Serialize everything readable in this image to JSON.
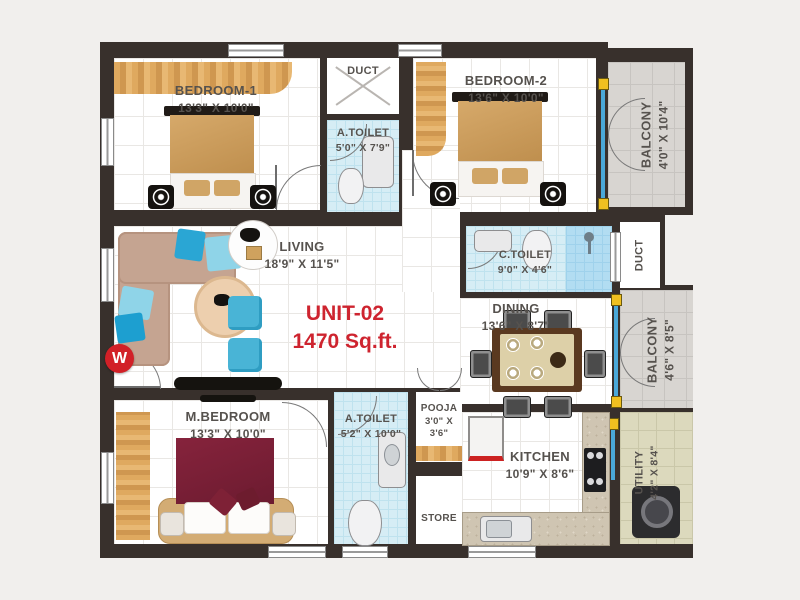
{
  "unit": {
    "title": "UNIT-02",
    "area": "1470 Sq.ft."
  },
  "compass": {
    "west_label": "W"
  },
  "rooms": {
    "bedroom1": {
      "name": "BEDROOM-1",
      "dims": "13'3\" X 10'0\""
    },
    "duct_top": {
      "name": "DUCT"
    },
    "atoilet1": {
      "name": "A.TOILET",
      "dims": "5'0\" X 7'9\""
    },
    "bedroom2": {
      "name": "BEDROOM-2",
      "dims": "13'6\" X 10'0\""
    },
    "balcony1": {
      "name": "BALCONY",
      "dims": "4'0\" X 10'4\""
    },
    "living": {
      "name": "LIVING",
      "dims": "18'9\" X 11'5\""
    },
    "ctoilet": {
      "name": "C.TOILET",
      "dims": "9'0\" X 4'6\""
    },
    "duct_right": {
      "name": "DUCT"
    },
    "dining": {
      "name": "DINING",
      "dims": "13'6\" X 8'7\""
    },
    "balcony2": {
      "name": "BALCONY",
      "dims": "4'6\" X 8'5\""
    },
    "mbedroom": {
      "name": "M.BEDROOM",
      "dims": "13'3\" X 10'0\""
    },
    "atoilet2": {
      "name": "A.TOILET",
      "dims": "5'2\" X 10'0\""
    },
    "pooja": {
      "name": "POOJA",
      "dims": "3'0\" X 3'6\""
    },
    "store": {
      "name": "STORE"
    },
    "kitchen": {
      "name": "KITCHEN",
      "dims": "10'9\" X 8'6\""
    },
    "utility": {
      "name": "UTILITY",
      "dims": "4'2\" X 8'4\""
    }
  },
  "colors": {
    "wall": "#38302c",
    "accent_red": "#ce242f",
    "tile_blue": "#d6edf5"
  }
}
